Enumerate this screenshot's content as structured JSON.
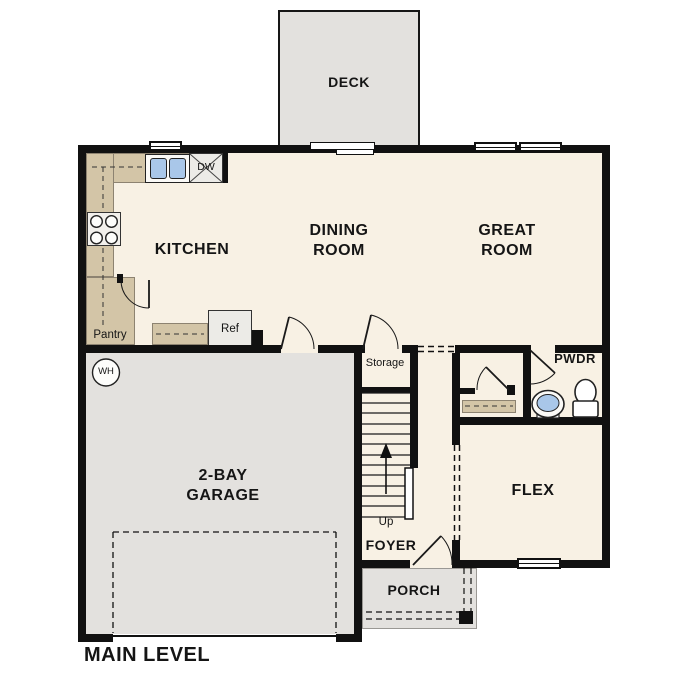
{
  "plan_title": "MAIN LEVEL",
  "rooms": {
    "deck": {
      "label": "DECK"
    },
    "kitchen": {
      "label": "KITCHEN"
    },
    "dining": {
      "line1": "DINING",
      "line2": "ROOM"
    },
    "great": {
      "line1": "GREAT",
      "line2": "ROOM"
    },
    "garage": {
      "line1": "2-BAY",
      "line2": "GARAGE"
    },
    "flex": {
      "label": "FLEX"
    },
    "foyer": {
      "label": "FOYER"
    },
    "porch": {
      "label": "PORCH"
    },
    "powder": {
      "label": "PWDR"
    },
    "storage": {
      "label": "Storage"
    },
    "pantry": {
      "label": "Pantry"
    }
  },
  "fixtures": {
    "refrigerator": "Ref",
    "dishwasher": "DW",
    "water_heater": "WH",
    "stair_direction": "Up"
  },
  "colors": {
    "wall": "#111111",
    "floor": "#f8f1e4",
    "garage_deck_porch_floor": "#e3e1de",
    "counter": "#d3c5a7",
    "sink_water": "#a9c7e9"
  }
}
